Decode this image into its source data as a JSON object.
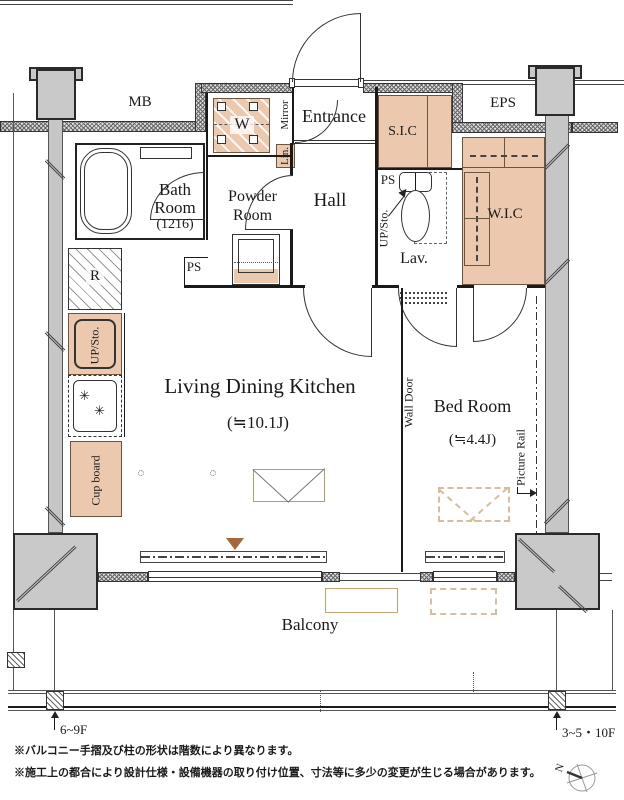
{
  "plan": {
    "rooms": {
      "mb": "MB",
      "eps": "EPS",
      "entrance": "Entrance",
      "sic": "S.I.C",
      "hall": "Hall",
      "lav": "Lav.",
      "wic": "W.I.C",
      "bath": [
        "Bath",
        "Room",
        "(1216)"
      ],
      "powder": [
        "Powder",
        "Room"
      ],
      "ldk": {
        "name": "Living Dining Kitchen",
        "area": "(≒10.1J)"
      },
      "bed": {
        "name": "Bed Room",
        "area": "(≒4.4J)"
      },
      "balcony": "Balcony"
    },
    "fixtures": {
      "washer": "W",
      "fridge": "R",
      "mirror": "Mirror",
      "linen": "Lin.",
      "ps_powder": "PS",
      "ps_lav": "PS",
      "upsto_lav": "UP/Sto.",
      "upsto_kitchen": "UP/Sto.",
      "cupboard": "Cup board",
      "wall_door": "Wall Door",
      "picture_rail": "Picture Rail"
    },
    "annotations": {
      "floor_left": "6~9F",
      "floor_right": "3~5・10F",
      "compass_n": "N",
      "notes": [
        "※バルコニー手摺及び柱の形状は階数により異なります。",
        "※施工上の都合により設計仕様・設備機器の取り付け位置、寸法等に多少の変更が生じる場合があります。"
      ]
    },
    "colors": {
      "closet_tan": "#ecc9ae",
      "outline_tan": "#b99b72",
      "column_gray": "#c9c9c9",
      "line": "#1a1a1a",
      "balcony_triangle": "#a5683a"
    }
  }
}
